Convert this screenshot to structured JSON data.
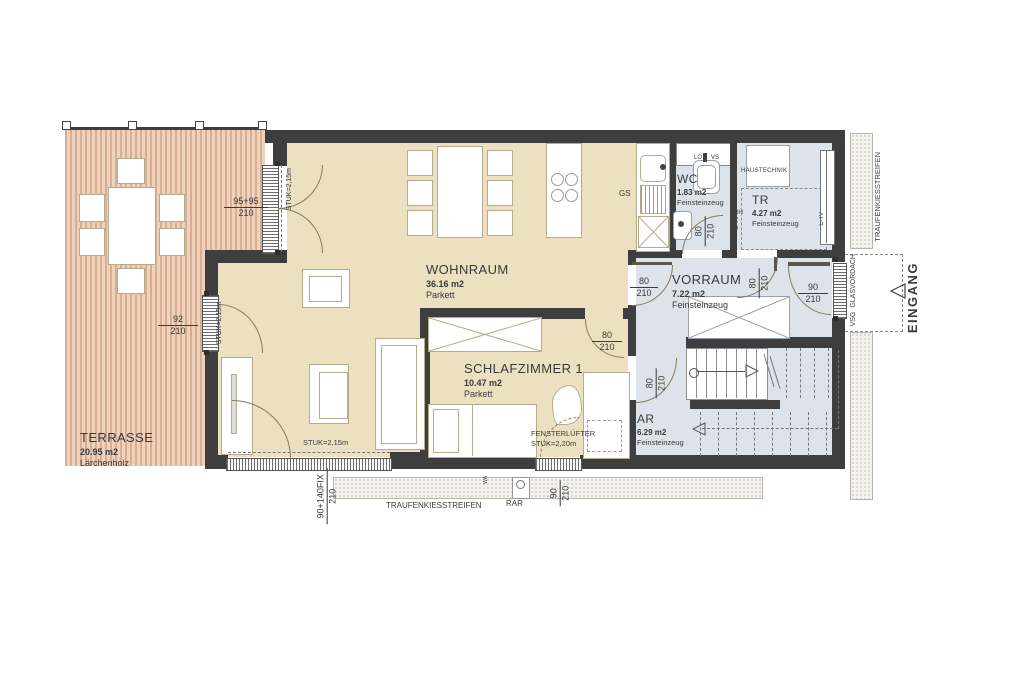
{
  "rooms": {
    "terrasse": {
      "name": "TERRASSE",
      "area": "20.95 m2",
      "floor": "Lärchenholz"
    },
    "wohnraum": {
      "name": "WOHNRAUM",
      "area": "36.16 m2",
      "floor": "Parkett"
    },
    "schlafzimmer1": {
      "name": "SCHLAFZIMMER 1",
      "area": "10.47 m2",
      "floor": "Parkett"
    },
    "wc": {
      "name": "WC",
      "area": "1.83 m2",
      "floor": "Feinsteinzeug"
    },
    "tr": {
      "name": "TR",
      "area": "4.27 m2",
      "floor": "Feinsteinzeug"
    },
    "vorraum": {
      "name": "VORRAUM",
      "area": "7.22 m2",
      "floor": "Feinsteinzeug"
    },
    "ar": {
      "name": "AR",
      "area": "6.29 m2",
      "floor": "Feinsteinzeug"
    }
  },
  "dims": {
    "terrace_door": {
      "w": "95+95",
      "h": "210"
    },
    "west_door": {
      "w": "92",
      "h": "210"
    },
    "south_window": {
      "w": "90+140FIX",
      "h": "210"
    },
    "bedroom_window": {
      "w": "90",
      "h": "210"
    },
    "entry_door": {
      "w": "90",
      "h": "210"
    },
    "door_wv": {
      "w": "80",
      "h": "210"
    },
    "door_wc": {
      "w": "80",
      "h": "210"
    },
    "door_tr": {
      "w": "80",
      "h": "210"
    },
    "door_schlaf": {
      "w": "80",
      "h": "210"
    },
    "door_ar": {
      "w": "80",
      "h": "210"
    }
  },
  "ann": {
    "haustechnik": "HAUSTECHNIK",
    "gs": "GS",
    "lo": "LO",
    "vs": "VS",
    "fbh": "FBH",
    "etv": "E-TV",
    "rar": "RAR",
    "wa": "WA",
    "eingang": "EINGANG",
    "glasvordach": "VSG  GLASVORDACH",
    "traufenkies": "TRAUFENKIESSTREIFEN",
    "stuk215": "STUK=2,15m",
    "fensterluefter": "FENSTERLÜFTER",
    "stuk220": "STUK=2,20m"
  },
  "colors": {
    "wall": "#3e3e3e",
    "parquet_floor": "#ece0c0",
    "tile_floor": "#dde3ea",
    "deck_wood": "#e7c6ad",
    "door_swing": "#8b7b5f"
  }
}
